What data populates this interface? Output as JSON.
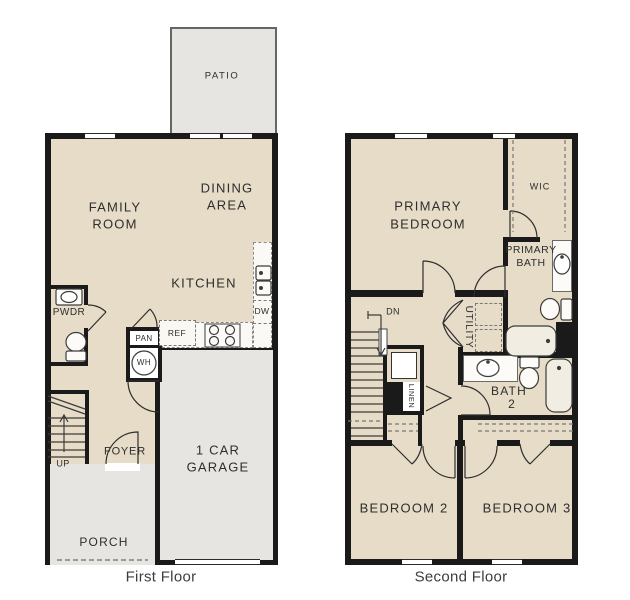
{
  "colors": {
    "floor": "#e6dcc7",
    "outdoor": "#e6e5e2",
    "wall": "#1a1a1a",
    "label_text": "#2e2e2e",
    "caption_text": "#3d3d3d",
    "fixture_line": "#3c3c3c"
  },
  "first_floor": {
    "caption": "First Floor",
    "patio_label": "PATIO",
    "family_room_line1": "FAMILY",
    "family_room_line2": "ROOM",
    "dining_line1": "DINING",
    "dining_line2": "AREA",
    "kitchen_label": "KITCHEN",
    "pwdr_label": "PWDR",
    "pan_label": "PAN",
    "ref_label": "REF",
    "dw_label": "DW",
    "wh_label": "WH",
    "foyer_label": "FOYER",
    "up_label": "UP",
    "garage_line1": "1 CAR",
    "garage_line2": "GARAGE",
    "porch_label": "PORCH"
  },
  "second_floor": {
    "caption": "Second Floor",
    "primary_bedroom_line1": "PRIMARY",
    "primary_bedroom_line2": "BEDROOM",
    "wic_label": "WIC",
    "primary_bath_line1": "PRIMARY",
    "primary_bath_line2": "BATH",
    "utility_label": "UTILITY",
    "dn_label": "DN",
    "linen_label": "LINEN",
    "bath2_line1": "BATH",
    "bath2_line2": "2",
    "bedroom2_label": "BEDROOM 2",
    "bedroom3_label": "BEDROOM 3"
  }
}
